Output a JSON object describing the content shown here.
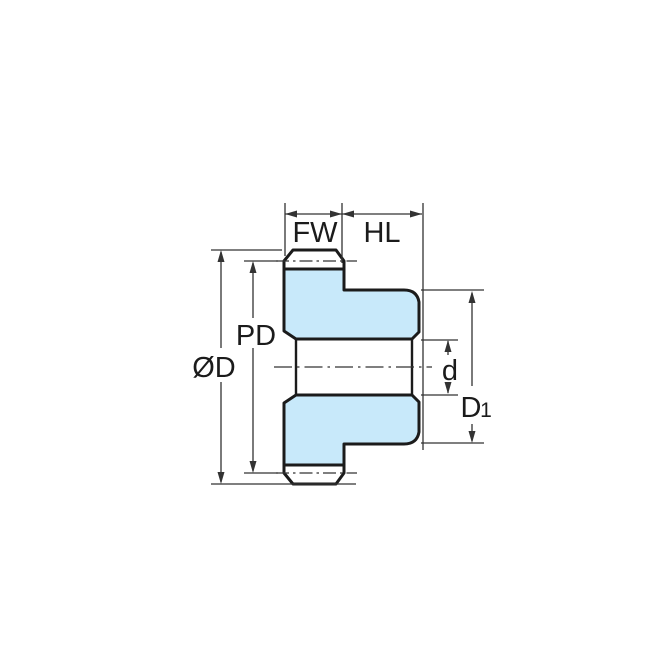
{
  "diagram": {
    "type": "technical-drawing",
    "subject": "spur-gear-cross-section",
    "colors": {
      "page_bg": "#ffffff",
      "gear_fill": "#C8E9FA",
      "outline": "#1b1b1b",
      "dimension_lines": "#333333",
      "text": "#1b1b1b"
    },
    "labels": {
      "face_width": "FW",
      "hub_length": "HL",
      "pitch_diameter": "PD",
      "outside_diameter": "ØD",
      "bore_diameter": "d",
      "hub_diameter_main": "D",
      "hub_diameter_sub": "1"
    }
  }
}
